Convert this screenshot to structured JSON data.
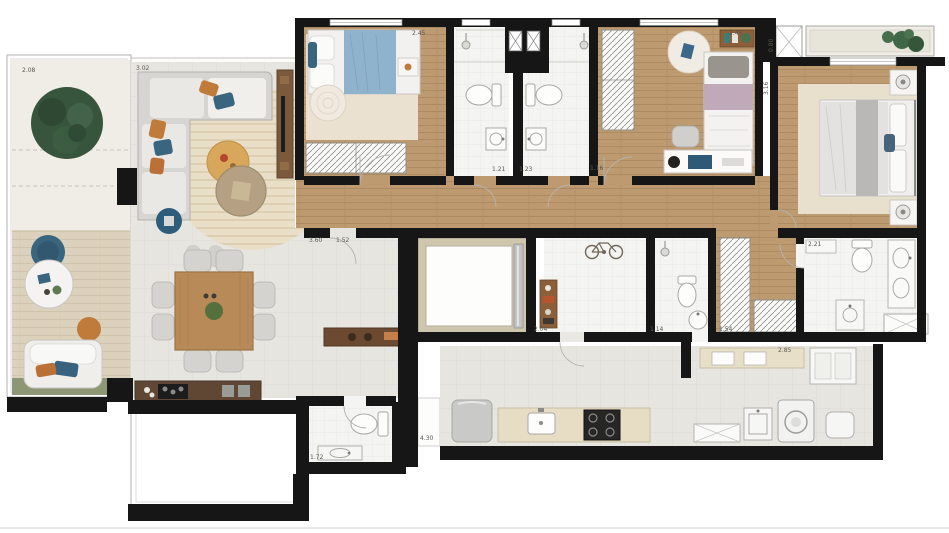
{
  "plan": {
    "type": "apartment-floor-plan",
    "labels": {
      "terrace": "2.08",
      "living": "3.02",
      "bedroom1": "2.45",
      "bath1": "1.21",
      "bath2": "1.23",
      "bedroom2_left": "1.16",
      "bedroom2": "2.45",
      "planter": "0.80",
      "master": "3.16",
      "hall_len": "3.60",
      "hall_wid": "1.52",
      "service_hall": "2.04",
      "service_bath": "1.14",
      "closet": "1.54",
      "master_bath": "2.21",
      "kitchen": "2.85",
      "powder": "1.72",
      "passage": "4.30"
    },
    "colors": {
      "wall": "#161616",
      "wood_floor": "#bd9a6f",
      "tile_floor": "#e7e5e0",
      "bath_floor": "#f4f4f2",
      "deck": "#dcd1bc",
      "grass": "#8d9675",
      "round_rug": "#e9dfc9",
      "bedroom_rug": "#eae1d1",
      "accent_blue": "#3a657f",
      "accent_orange": "#c07a3a",
      "plant_green": "#3f6647",
      "furniture_wood": "#6b4a31",
      "counter": "#e6ddc4"
    },
    "icons": [
      "tree-icon",
      "outdoor-armchair-icon",
      "round-table-icon",
      "pouf-icon",
      "sectional-sofa-icon",
      "round-rug-icon",
      "side-table-icon",
      "tv-panel-icon",
      "dining-table-icon",
      "dining-chair-icon",
      "island-counter-icon",
      "console-icon",
      "single-bed-icon",
      "wardrobe-icon",
      "round-jute-rug-icon",
      "desk-icon",
      "desk-chair-icon",
      "shelf-icon",
      "double-bed-icon",
      "nightstand-icon",
      "lamp-icon",
      "planter-plants-icon",
      "elevator-icon",
      "bike-rack-icon",
      "shower-icon",
      "toilet-icon",
      "sink-icon",
      "vanity-icon",
      "shower-tray-icon",
      "fridge-icon",
      "cooktop-icon",
      "kitchen-sink-icon",
      "laundry-sink-icon",
      "washing-machine-icon",
      "ironing-table-icon",
      "cabinet-icon"
    ]
  }
}
